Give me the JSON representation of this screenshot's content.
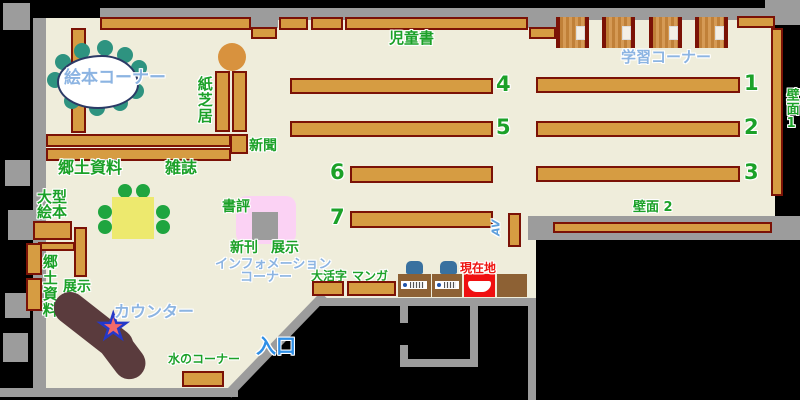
{
  "map": {
    "labels": {
      "picture_book_corner": "絵本コーナー",
      "kamishibai": "紙芝居",
      "newspaper": "新聞",
      "local_materials_top": "郷土資料",
      "magazines": "雑誌",
      "childrens_books": "児童書",
      "study_corner": "学習コーナー",
      "wall_1": "壁面1",
      "wall_2": "壁面 2",
      "large_picture_books_line1": "大型",
      "large_picture_books_line2": "絵本",
      "display_left": "展示",
      "local_materials_left": "郷土資料",
      "book_review": "書評",
      "new_books": "新刊",
      "display_center": "展示",
      "information_corner_line1": "インフォメーション",
      "information_corner_line2": "コーナー",
      "large_print": "大活字",
      "manga": "マンガ",
      "av": "AV",
      "current_location": "現在地",
      "counter": "カウンター",
      "water_corner": "水のコーナー",
      "entrance": "入口"
    },
    "shelf_numbers": [
      "1",
      "2",
      "3",
      "4",
      "5",
      "6",
      "7"
    ],
    "icons": {
      "counter_star": "★"
    },
    "colors": {
      "floor": "#EFEDDB",
      "wall_gray": "#9C9C9C",
      "outside_black": "#000000",
      "shelf_fill": "#D69C42",
      "shelf_border": "#7B1206",
      "counter_brown": "#5A3B3D",
      "table_yellow": "#EDE96E",
      "chair_green": "#1FA53F",
      "stool_teal": "#2E9380",
      "display_pink": "#FBD2F4",
      "current_location_red": "#F01010",
      "terminal_chair_blue": "#39719F",
      "text_green": "#1BA128",
      "text_light_blue": "#8CB4E2",
      "text_entrance_blue": "#2F8FE6",
      "text_red": "#EE1510"
    }
  }
}
